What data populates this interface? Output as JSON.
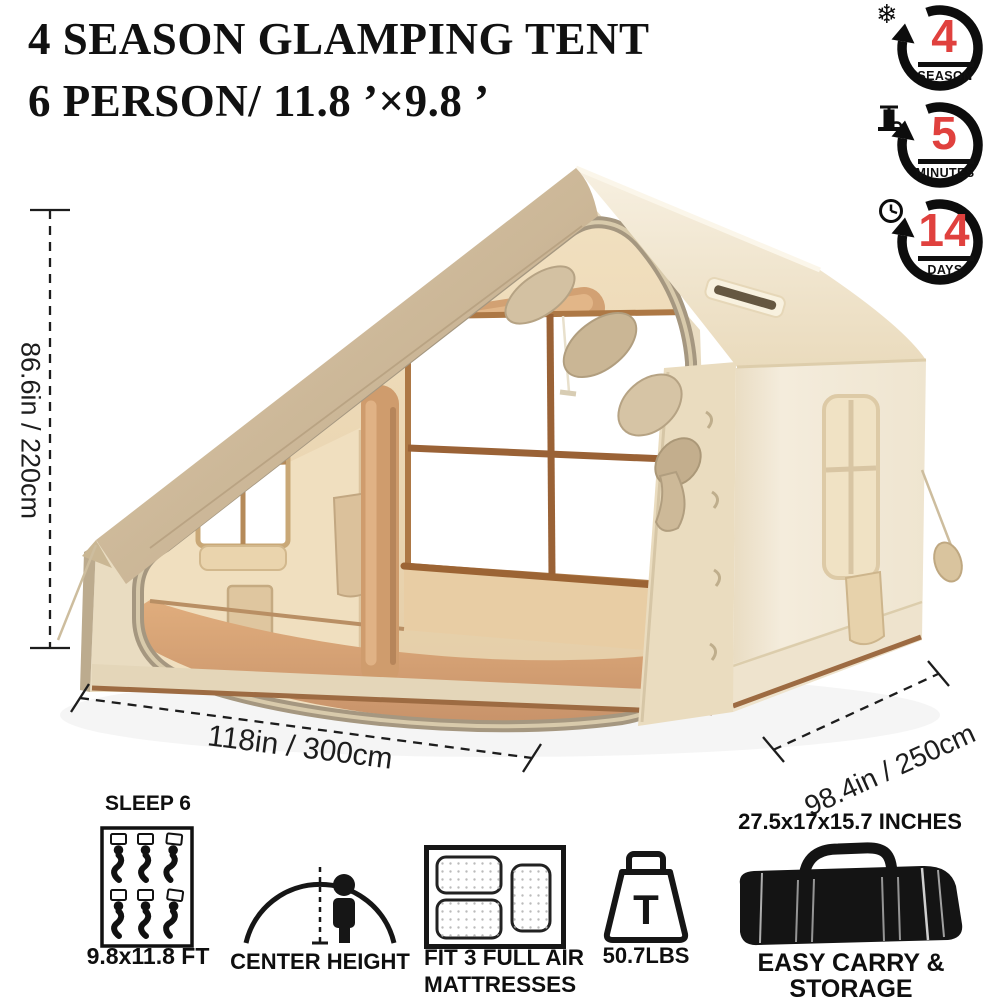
{
  "title": {
    "line1": "4 SEASON GLAMPING TENT",
    "line2": "6 PERSON/ 11.8 ’×9.8 ’"
  },
  "badges": [
    {
      "value": "4",
      "label": "SEASON",
      "icon": "snowflake",
      "glyph": "❄"
    },
    {
      "value": "5",
      "label": "MINUTES",
      "icon": "air-pump"
    },
    {
      "value": "14",
      "label": "DAYS",
      "icon": "clock"
    }
  ],
  "dimensions": {
    "height_label": "86.6in / 220cm",
    "width_label": "118in / 300cm",
    "depth_label": "98.4in / 250cm"
  },
  "features": [
    {
      "title": "SLEEP 6",
      "caption": "9.8x11.8 FT",
      "icon": "sleep-6-people"
    },
    {
      "caption": "CENTER HEIGHT",
      "icon": "dome-tent-with-person"
    },
    {
      "caption_line1": "FIT 3 FULL AIR",
      "caption_line2": "MATTRESSES",
      "icon": "air-mattresses"
    },
    {
      "caption": "50.7LBS",
      "icon": "weight",
      "icon_letter": "T"
    },
    {
      "title": "27.5x17x15.7 INCHES",
      "caption": "EASY CARRY & STORAGE",
      "icon": "duffel-bag"
    }
  ],
  "colors": {
    "accent_red": "#e0413e",
    "text_black": "#111111",
    "roof_tan": "#cdb796",
    "roof_light": "#f3ead7",
    "wall_cream": "#f3ebda",
    "interior_tan": "#ead6b4",
    "wood_brown": "#9c6434",
    "floor_tan": "#d9a576",
    "rim_khaki": "#a59780"
  }
}
